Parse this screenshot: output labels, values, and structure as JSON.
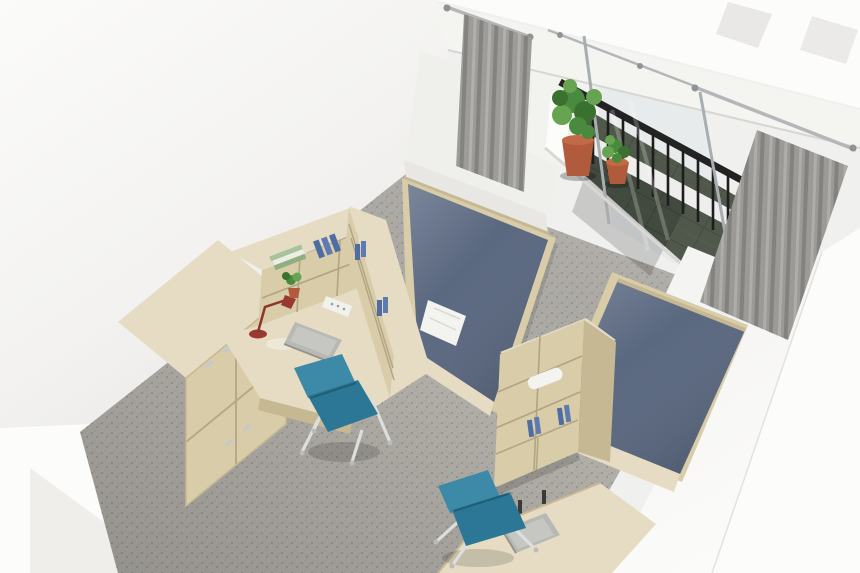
{
  "scene": {
    "description": "Aerial 3D architectural render of a twin dormitory room with a balcony, viewed as a diagonal dollhouse cutaway",
    "room": {
      "floor": "grey terrazzo carpet",
      "walls": "white cutaway walls"
    },
    "balcony": {
      "floor": "dark green stone tiles",
      "railing": "black metal balustrade with white ledge",
      "door": "aluminium framed sliding glass door",
      "curtains": [
        "grey curtain left",
        "grey curtain right"
      ],
      "plants": [
        "large leafy plant in terracotta pot",
        "small shrub in terracotta pot"
      ]
    },
    "furniture": {
      "bed_left": {
        "mattress": "denim blue",
        "frame": "light ash wood",
        "accessory": "folded white towel"
      },
      "bed_right": {
        "mattress": "denim blue",
        "frame": "light ash wood"
      },
      "desk_left": {
        "type": "L-shaped corner desk with bookshelf hutch",
        "items": [
          "red desk lamp",
          "grey laptop",
          "white power strip",
          "small potted plant",
          "stacked books",
          "blue binders",
          "white storage box"
        ]
      },
      "wardrobe": {
        "type": "four-door locker wardrobe",
        "hardware": "metal handles"
      },
      "shelf_right": {
        "type": "bookshelf with lower cabinet",
        "items": [
          "rolled white towel",
          "blue binders"
        ]
      },
      "desk_right": {
        "items": [
          "grey laptop"
        ]
      },
      "chairs": [
        "teal desk chair at left desk",
        "teal desk chair at right desk"
      ],
      "adjacent_room": {
        "door": "wooden panel door seen from above"
      }
    }
  },
  "colors": {
    "bg": "#f0f0ee",
    "wall": "#f6f5f3",
    "wall-shade": "#e8e7e4",
    "wall-bright": "#fcfcfa",
    "beam": "#f4f4f1",
    "beam-edge": "#d7d6d3",
    "floor": "#b3b0aa",
    "floor-speck-dark": "#8d8a84",
    "floor-speck-mid": "#7d7a74",
    "floor-speck-light": "#a5a19b",
    "balcony-floor": "#4f584a",
    "balcony-grout": "#3b463a",
    "railing": "#232323",
    "curtain": "#a7a6a3",
    "curtain-dark": "#8d8c89",
    "curtain-light": "#bcbbb8",
    "rod": "#b4b7b9",
    "rod-dark": "#8f9396",
    "wood": "#e5dcc3",
    "wood-mid": "#d8cca9",
    "wood-dark": "#c6b893",
    "wood-shadow": "#b2a482",
    "mattress": "#5a6880",
    "mattress-dark": "#4b5870",
    "towel": "#f3f3f0",
    "binder-blue": "#4f6da3",
    "book-green": "#a8c29a",
    "book-cream": "#eceee4",
    "box-white": "#f6f6f3",
    "chair": "#2c7795",
    "chair-light": "#3d89a8",
    "chair-leg": "#dededc",
    "lamp": "#993a31",
    "plant": "#4a8a3e",
    "plant-dark": "#3a7030",
    "plant-light": "#66a452",
    "pot": "#b05c3c",
    "pot-rim": "#c26a45",
    "laptop": "#b8b8b5",
    "laptop-dark": "#94948f",
    "door-wood": "#d6c49c",
    "door-wood-dark": "#bfab7e",
    "glass": "#dde3e6"
  }
}
